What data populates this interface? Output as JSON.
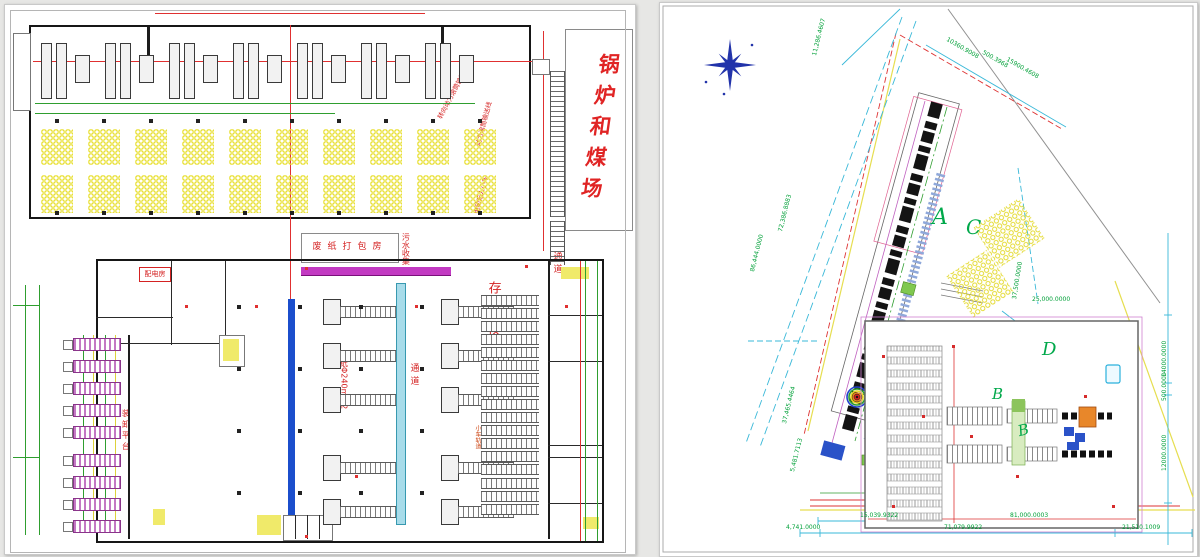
{
  "left_drawing": {
    "boiler_coal_yard_label": "锅炉和煤场",
    "labels": {
      "turning_conveyor": "转向动力滚筒输送线",
      "power_roller_conveyor": "动力滚筒输送线",
      "unmanned_cart": "电动无人小车",
      "waste_paper_baling_room": "废纸打包房",
      "sewage_collection": "污水收集",
      "storage_area": "存放区",
      "aisle_a": "通道",
      "aisle_b": "通道",
      "paper_cutting": "切纸Φ240mm2",
      "loading_dock": "装卸平台",
      "power_distribution_room": "配电房",
      "cart_track": "小车轨道"
    }
  },
  "right_drawing": {
    "region_labels": {
      "a": "A",
      "b": "B",
      "b2": "B",
      "c": "C",
      "d": "D"
    },
    "dimensions": {
      "top_1": "10360.9008",
      "top_2": "500.3968",
      "top_3": "15900.4608",
      "top_left": "11,286.4607",
      "left_1": "72,386.8883",
      "left_2": "86,444.0000",
      "left_3": "37,465.4464",
      "left_4": "5,481.7113",
      "right_1": "37,500.0000",
      "right_2": "25,000.0000",
      "right_3": "14000.0000",
      "right_4": "500.0000",
      "right_5": "12000.0000",
      "bottom_1": "15,039.9322",
      "bottom_2": "81,000.0003",
      "bottom_3": "4,741.0000",
      "bottom_4": "71,079.9922",
      "bottom_5": "21,510.1009"
    }
  },
  "colors": {
    "dimension_green": "#00a038",
    "annotation_red": "#e03030",
    "roll_yellow": "#e9e038",
    "dim_cyan": "#39b8d8",
    "conveyor_blue": "#1b4ecc",
    "bar_magenta": "#c23ac2",
    "dock_purple": "#c478c4",
    "compass_blue": "#2233aa",
    "region_green": "#00a84a"
  }
}
